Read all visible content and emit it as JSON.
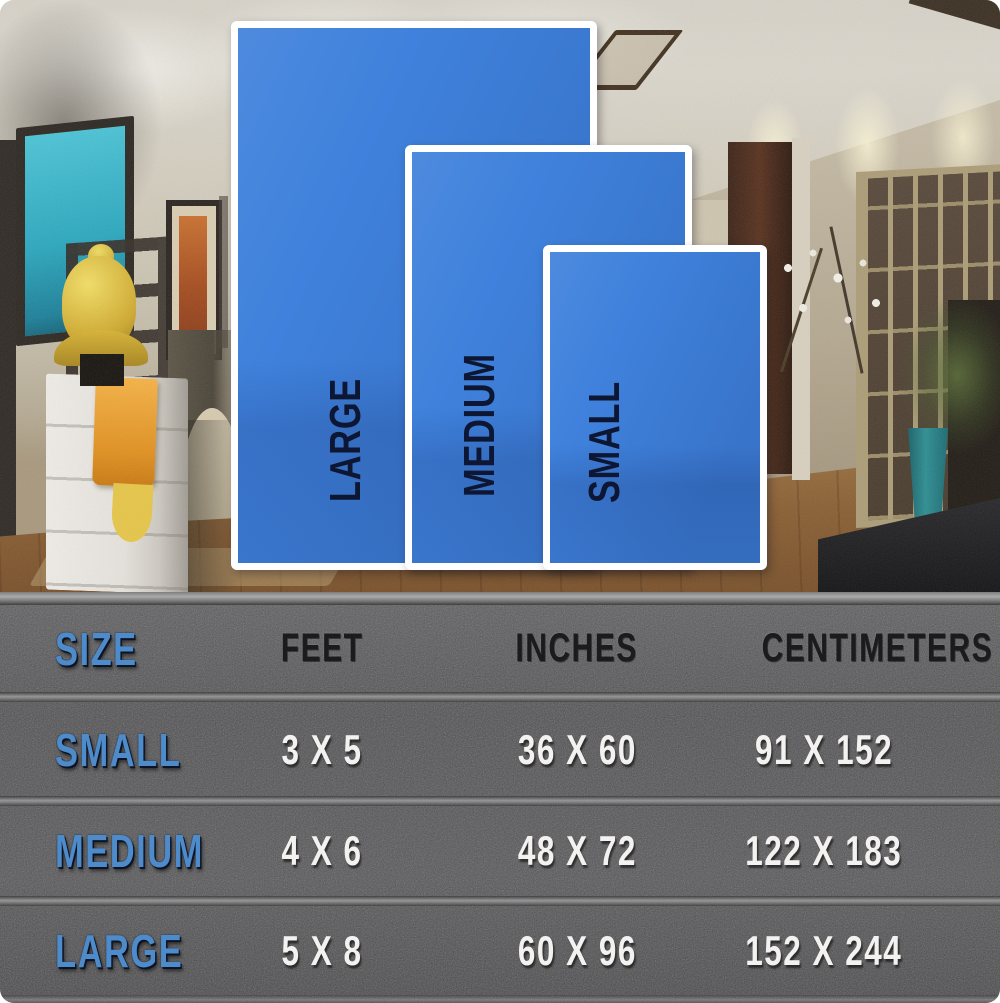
{
  "chart_data": {
    "type": "table",
    "title": "Rug size comparison chart",
    "columns": [
      "SIZE",
      "FEET",
      "INCHES",
      "CENTIMETERS"
    ],
    "rows": [
      [
        "SMALL",
        "3 X 5",
        "36 X 60",
        "91 X 152"
      ],
      [
        "MEDIUM",
        "4 X 6",
        "48 X 72",
        "122 X 183"
      ],
      [
        "LARGE",
        "5 X 8",
        "60 X 96",
        "152 X 244"
      ]
    ],
    "overlay_size_labels": [
      "LARGE",
      "MEDIUM",
      "SMALL"
    ]
  },
  "overlay": {
    "rugs": [
      {
        "id": "large",
        "label": "LARGE"
      },
      {
        "id": "medium",
        "label": "MEDIUM"
      },
      {
        "id": "small",
        "label": "SMALL"
      }
    ],
    "rug_color": "#3f81dc",
    "rug_border_color": "#ffffff",
    "label_color": "#0d1733"
  },
  "table": {
    "columns": [
      {
        "label": "SIZE"
      },
      {
        "label": "FEET"
      },
      {
        "label": "INCHES"
      },
      {
        "label": "CENTIMETERS"
      }
    ],
    "rows": [
      {
        "size": "SMALL",
        "feet": "3 X 5",
        "inches": "36 X 60",
        "centimeters": "91 X 152"
      },
      {
        "size": "MEDIUM",
        "feet": "4 X 6",
        "inches": "48 X 72",
        "centimeters": "122 X 183"
      },
      {
        "size": "LARGE",
        "feet": "5 X 8",
        "inches": "60 X 96",
        "centimeters": "152 X 244"
      }
    ],
    "accent_color": "#4e8bca",
    "value_color": "#f3f2f0",
    "header_color": "#1b1b1e",
    "background_color": "#4f4f51"
  }
}
